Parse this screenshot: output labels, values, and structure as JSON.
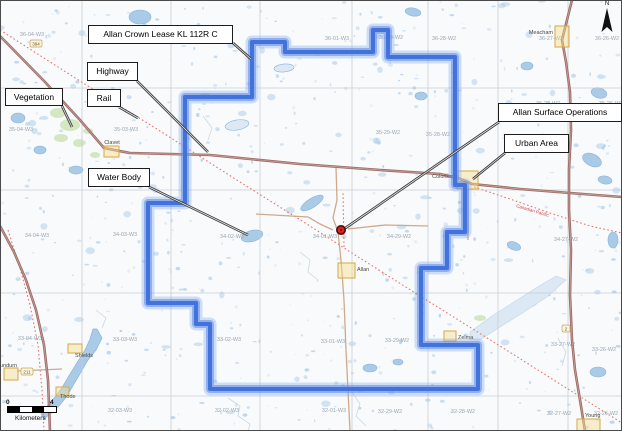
{
  "figure": {
    "width": 622,
    "height": 431
  },
  "north_label": "N",
  "scale_bar": {
    "start_label": "0",
    "end_label": "4",
    "caption": "Kilometers"
  },
  "callouts": [
    {
      "id": "lease",
      "label": "Allan Crown Lease KL 112R C",
      "box": [
        88,
        25,
        145,
        19
      ],
      "leader": [
        233,
        43,
        251,
        59
      ]
    },
    {
      "id": "highway",
      "label": "Highway",
      "box": [
        87,
        62,
        51,
        19
      ],
      "leader": [
        137,
        81,
        208,
        152
      ]
    },
    {
      "id": "rail",
      "label": "Rail",
      "box": [
        87,
        89,
        34,
        18
      ],
      "leader": [
        119,
        107,
        138,
        118
      ]
    },
    {
      "id": "vegetation",
      "label": "Vegetation",
      "box": [
        5,
        88,
        58,
        18
      ],
      "leader": [
        62,
        106,
        72,
        127
      ]
    },
    {
      "id": "water-body",
      "label": "Water Body",
      "box": [
        88,
        168,
        62,
        19
      ],
      "leader": [
        149,
        187,
        248,
        235
      ]
    },
    {
      "id": "allan-surface-operations",
      "label": "Allan Surface Operations",
      "box": [
        498,
        103,
        124,
        19
      ],
      "leader": [
        499,
        122,
        344,
        229
      ]
    },
    {
      "id": "urban-area",
      "label": "Urban Area",
      "box": [
        504,
        134,
        65,
        19
      ],
      "leader": [
        505,
        153,
        473,
        179
      ]
    }
  ],
  "lease_boundary_points": [
    [
      252,
      42
    ],
    [
      285,
      42
    ],
    [
      285,
      52
    ],
    [
      373,
      52
    ],
    [
      373,
      30
    ],
    [
      388,
      30
    ],
    [
      388,
      57
    ],
    [
      455,
      57
    ],
    [
      455,
      185
    ],
    [
      465,
      185
    ],
    [
      465,
      232
    ],
    [
      447,
      232
    ],
    [
      447,
      268
    ],
    [
      421,
      268
    ],
    [
      421,
      345
    ],
    [
      478,
      345
    ],
    [
      478,
      389
    ],
    [
      210,
      389
    ],
    [
      210,
      324
    ],
    [
      196,
      324
    ],
    [
      196,
      303
    ],
    [
      148,
      303
    ],
    [
      148,
      203
    ],
    [
      185,
      203
    ],
    [
      185,
      97
    ],
    [
      252,
      97
    ]
  ],
  "mine_marker": {
    "x": 341,
    "y": 230
  },
  "grid_labels": [
    {
      "t": "36-04-W3",
      "x": 32,
      "y": 36
    },
    {
      "t": "36-01-W3",
      "x": 337,
      "y": 40
    },
    {
      "t": "36-29-W2",
      "x": 391,
      "y": 39
    },
    {
      "t": "36-28-W2",
      "x": 444,
      "y": 40
    },
    {
      "t": "36-27-W2",
      "x": 551,
      "y": 40
    },
    {
      "t": "36-26-W2",
      "x": 607,
      "y": 40
    },
    {
      "t": "35-04-W3",
      "x": 21,
      "y": 131
    },
    {
      "t": "35-03-W3",
      "x": 126,
      "y": 131
    },
    {
      "t": "35-29-W2",
      "x": 388,
      "y": 134
    },
    {
      "t": "35-28-W2",
      "x": 438,
      "y": 136
    },
    {
      "t": "35-27-W2",
      "x": 548,
      "y": 105
    },
    {
      "t": "35-26-W2",
      "x": 611,
      "y": 105
    },
    {
      "t": "34-04-W3",
      "x": 37,
      "y": 237
    },
    {
      "t": "34-03-W3",
      "x": 125,
      "y": 236
    },
    {
      "t": "34-02-W3",
      "x": 232,
      "y": 238
    },
    {
      "t": "34-01-W3",
      "x": 325,
      "y": 238
    },
    {
      "t": "34-29-W2",
      "x": 399,
      "y": 238
    },
    {
      "t": "34-27-W2",
      "x": 566,
      "y": 241
    },
    {
      "t": "33-04-W3",
      "x": 30,
      "y": 340
    },
    {
      "t": "33-03-W3",
      "x": 125,
      "y": 341
    },
    {
      "t": "33-02-W3",
      "x": 229,
      "y": 341
    },
    {
      "t": "33-01-W3",
      "x": 333,
      "y": 343
    },
    {
      "t": "33-29-W2",
      "x": 397,
      "y": 342
    },
    {
      "t": "33-27-W2",
      "x": 563,
      "y": 346
    },
    {
      "t": "33-26-W2",
      "x": 604,
      "y": 351
    },
    {
      "t": "32-04-W3",
      "x": 26,
      "y": 410
    },
    {
      "t": "32-03-W3",
      "x": 120,
      "y": 412
    },
    {
      "t": "32-02-W3",
      "x": 227,
      "y": 412
    },
    {
      "t": "32-01-W3",
      "x": 334,
      "y": 412
    },
    {
      "t": "32-29-W2",
      "x": 390,
      "y": 413
    },
    {
      "t": "32-28-W2",
      "x": 463,
      "y": 413
    },
    {
      "t": "32-27-W2",
      "x": 559,
      "y": 415
    },
    {
      "t": "32-26-W2",
      "x": 606,
      "y": 415
    }
  ],
  "towns": [
    {
      "name": "Clavet",
      "poly": [
        104,
        146,
        15,
        11
      ],
      "label": [
        112,
        144
      ],
      "anchor": "middle"
    },
    {
      "name": "Allan",
      "poly": [
        338,
        263,
        17,
        15
      ],
      "label": [
        357,
        271
      ],
      "anchor": "start"
    },
    {
      "name": "Meacham",
      "poly": [
        555,
        26,
        14,
        21
      ],
      "label": [
        553,
        34
      ],
      "anchor": "end"
    },
    {
      "name": "Colonsay",
      "poly": [
        457,
        171,
        21,
        18
      ],
      "label": [
        455,
        178
      ],
      "anchor": "end"
    },
    {
      "name": "Zelma",
      "poly": [
        444,
        331,
        12,
        10
      ],
      "label": [
        458,
        339
      ],
      "anchor": "start"
    },
    {
      "name": "Young",
      "poly": [
        577,
        419,
        23,
        12
      ],
      "label": [
        585,
        417
      ],
      "anchor": "start"
    },
    {
      "name": "Dundurn",
      "poly": [
        4,
        368,
        14,
        12
      ],
      "label": [
        -4,
        367
      ],
      "anchor": "start"
    },
    {
      "name": "Shields",
      "poly": [
        68,
        344,
        14,
        9
      ],
      "label": [
        75,
        357
      ],
      "anchor": "start"
    },
    {
      "name": "Thode",
      "poly": [
        56,
        387,
        13,
        9
      ],
      "label": [
        60,
        398
      ],
      "anchor": "start"
    }
  ],
  "highway_shields": [
    {
      "text": "394",
      "x": 36,
      "y": 44
    },
    {
      "text": "211",
      "x": 27,
      "y": 372
    },
    {
      "text": "2",
      "x": 566,
      "y": 329
    }
  ],
  "rail_label": {
    "text": "Canadian Pacific",
    "x": 516,
    "y": 207,
    "angle": 17
  },
  "roads_major": [
    [
      [
        0,
        36
      ],
      [
        45,
        82
      ],
      [
        80,
        120
      ],
      [
        104,
        148
      ],
      [
        130,
        153
      ],
      [
        210,
        155
      ],
      [
        300,
        164
      ],
      [
        380,
        170
      ],
      [
        440,
        174
      ],
      [
        458,
        178
      ],
      [
        472,
        184
      ],
      [
        520,
        189
      ],
      [
        570,
        193
      ],
      [
        622,
        197
      ]
    ],
    [
      [
        0,
        226
      ],
      [
        14,
        252
      ],
      [
        26,
        280
      ],
      [
        36,
        310
      ],
      [
        44,
        345
      ],
      [
        48,
        380
      ],
      [
        50,
        431
      ]
    ],
    [
      [
        572,
        0
      ],
      [
        567,
        20
      ],
      [
        562,
        40
      ],
      [
        566,
        62
      ],
      [
        570,
        92
      ],
      [
        571,
        130
      ],
      [
        569,
        170
      ],
      [
        569,
        210
      ],
      [
        571,
        250
      ],
      [
        570,
        295
      ],
      [
        572,
        340
      ],
      [
        575,
        370
      ],
      [
        580,
        400
      ],
      [
        585,
        431
      ]
    ]
  ],
  "roads_minor": [
    [
      [
        336,
        167
      ],
      [
        337,
        200
      ],
      [
        333,
        218
      ],
      [
        338,
        232
      ],
      [
        341,
        260
      ],
      [
        344,
        300
      ],
      [
        346,
        350
      ],
      [
        350,
        431
      ]
    ],
    [
      [
        256,
        214
      ],
      [
        308,
        217
      ],
      [
        320,
        224
      ],
      [
        333,
        230
      ]
    ],
    [
      [
        348,
        229
      ],
      [
        385,
        225
      ],
      [
        428,
        226
      ]
    ],
    [
      [
        17,
        371
      ],
      [
        62,
        369
      ]
    ],
    [
      [
        468,
        189
      ],
      [
        468,
        240
      ]
    ]
  ],
  "rails": [
    [
      [
        0,
        30
      ],
      [
        80,
        81
      ],
      [
        160,
        131
      ],
      [
        240,
        182
      ],
      [
        310,
        226
      ],
      [
        344,
        248
      ],
      [
        420,
        296
      ],
      [
        500,
        346
      ],
      [
        560,
        384
      ],
      [
        622,
        423
      ]
    ],
    [
      [
        474,
        187
      ],
      [
        510,
        199
      ],
      [
        550,
        213
      ],
      [
        590,
        226
      ],
      [
        622,
        233
      ]
    ],
    [
      [
        344,
        247
      ],
      [
        343,
        193
      ]
    ],
    [
      [
        8,
        230
      ],
      [
        20,
        268
      ],
      [
        30,
        305
      ],
      [
        38,
        345
      ],
      [
        42,
        390
      ],
      [
        44,
        431
      ]
    ]
  ],
  "lakes": [
    {
      "e": [
        252,
        236,
        11,
        5.5,
        -15
      ],
      "deep": true
    },
    {
      "e": [
        312,
        203,
        13,
        4.5,
        -32
      ],
      "deep": true
    },
    {
      "e": [
        140,
        17,
        11,
        7,
        0
      ],
      "deep": true
    },
    {
      "e": [
        413,
        12,
        8,
        4,
        10
      ],
      "deep": true
    },
    {
      "e": [
        592,
        160,
        10,
        6,
        25
      ],
      "deep": true
    },
    {
      "e": [
        605,
        180,
        7,
        4,
        10
      ],
      "deep": true
    },
    {
      "e": [
        527,
        66,
        6,
        4,
        0
      ],
      "deep": true
    },
    {
      "e": [
        599,
        93,
        8,
        5,
        15
      ],
      "deep": true
    },
    {
      "e": [
        613,
        240,
        5,
        8,
        0
      ],
      "deep": true
    },
    {
      "e": [
        76,
        170,
        7,
        4,
        0
      ],
      "deep": true
    },
    {
      "e": [
        40,
        150,
        6,
        4,
        0
      ],
      "deep": true
    },
    {
      "e": [
        18,
        118,
        7,
        5,
        0
      ],
      "deep": true
    },
    {
      "e": [
        598,
        372,
        8,
        5,
        0
      ],
      "deep": true
    },
    {
      "e": [
        421,
        96,
        6,
        4,
        0
      ],
      "deep": true
    },
    {
      "e": [
        514,
        246,
        7,
        4,
        20
      ],
      "deep": true
    },
    {
      "e": [
        370,
        368,
        7,
        4,
        0
      ],
      "deep": true
    },
    {
      "e": [
        398,
        362,
        5,
        3,
        0
      ],
      "deep": true
    },
    {
      "e": [
        237,
        125,
        12,
        5,
        -10
      ],
      "deep": false
    },
    {
      "e": [
        284,
        68,
        10,
        4,
        -5
      ],
      "deep": false
    }
  ],
  "blackstrap_lake_points": [
    [
      97,
      329
    ],
    [
      102,
      338
    ],
    [
      96,
      350
    ],
    [
      88,
      360
    ],
    [
      81,
      372
    ],
    [
      74,
      384
    ],
    [
      67,
      396
    ],
    [
      59,
      406
    ],
    [
      50,
      414
    ],
    [
      44,
      419
    ],
    [
      41,
      414
    ],
    [
      48,
      405
    ],
    [
      56,
      396
    ],
    [
      63,
      386
    ],
    [
      70,
      374
    ],
    [
      78,
      361
    ],
    [
      85,
      350
    ],
    [
      90,
      339
    ],
    [
      93,
      329
    ]
  ],
  "se_slough_points": [
    [
      470,
      332
    ],
    [
      492,
      316
    ],
    [
      514,
      302
    ],
    [
      536,
      288
    ],
    [
      556,
      276
    ],
    [
      566,
      280
    ],
    [
      548,
      296
    ],
    [
      524,
      312
    ],
    [
      500,
      327
    ],
    [
      480,
      340
    ],
    [
      470,
      340
    ]
  ],
  "veg_patches": [
    [
      58,
      113,
      8,
      5
    ],
    [
      70,
      125,
      10,
      6
    ],
    [
      61,
      138,
      7,
      4
    ],
    [
      79,
      143,
      6,
      4
    ],
    [
      88,
      131,
      5,
      3
    ],
    [
      205,
      96,
      6,
      3
    ],
    [
      530,
      303,
      7,
      4
    ],
    [
      545,
      292,
      5,
      3
    ],
    [
      95,
      155,
      5,
      3
    ],
    [
      480,
      318,
      6,
      3
    ]
  ],
  "creeks": [
    [
      [
        228,
        398
      ],
      [
        240,
        406
      ],
      [
        238,
        416
      ],
      [
        250,
        424
      ],
      [
        248,
        431
      ]
    ],
    [
      [
        352,
        392
      ],
      [
        360,
        404
      ],
      [
        356,
        416
      ],
      [
        366,
        426
      ]
    ],
    [
      [
        300,
        252
      ],
      [
        310,
        260
      ],
      [
        308,
        272
      ],
      [
        318,
        280
      ]
    ],
    [
      [
        203,
        116
      ],
      [
        212,
        128
      ],
      [
        208,
        140
      ]
    ],
    [
      [
        558,
        338
      ],
      [
        566,
        352
      ],
      [
        562,
        366
      ]
    ],
    [
      [
        96,
        310
      ],
      [
        106,
        318
      ],
      [
        102,
        328
      ]
    ]
  ],
  "grid_lines": {
    "vertical_x": [
      82,
      171,
      260,
      352,
      428,
      498,
      568
    ],
    "horizontal_y": [
      88,
      190,
      293,
      396
    ]
  },
  "colors": {
    "land": "#f8fafc",
    "water": "#a9cbe8",
    "water_stroke": "#8ab4da",
    "water_pale": "#dce8f3",
    "vegetation": "#cfe4ba",
    "grid_line": "#c3cbd2",
    "grid_label": "#9aa6b2",
    "road_major": "#9c6b68",
    "road_major_fill": "#c49a90",
    "road_minor": "#cfa98b",
    "rail": "#e4776a",
    "rail_text": "#cc4444",
    "lease_core": "#4273dd",
    "lease_mid": "rgba(96,136,230,0.55)",
    "lease_glow": "rgba(130,165,238,0.35)",
    "town_fill": "rgba(246,222,140,0.45)",
    "town_stroke": "#d8a843",
    "town_label": "#4a4a42",
    "leader": "#3f3f3f",
    "mine_ring": "#4a0d0d",
    "mine_fill": "#e01f1f",
    "frame": "#4a4a4a"
  }
}
